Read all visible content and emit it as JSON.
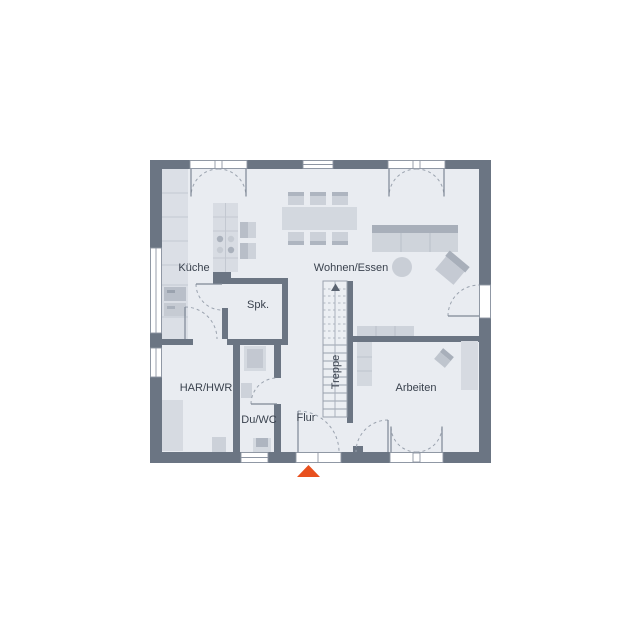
{
  "plan": {
    "type": "floor-plan",
    "rooms": {
      "kueche": {
        "label": "Küche"
      },
      "wohnen_essen": {
        "label": "Wohnen/Essen"
      },
      "spk": {
        "label": "Spk."
      },
      "treppe": {
        "label": "Treppe"
      },
      "har_hwr": {
        "label": "HAR/HWR"
      },
      "du_wc": {
        "label": "Du/WC"
      },
      "flur": {
        "label": "Flur"
      },
      "arbeiten": {
        "label": "Arbeiten"
      }
    },
    "markers": {
      "entrance_arrow": "entrance-triangle-south"
    },
    "colors": {
      "wall": "#6b7583",
      "floor": "#e9ecf1",
      "furniture_light": "#d7dbe2",
      "furniture_mid": "#c2c7d0",
      "furniture_dark": "#a9b0bb",
      "accent_entrance": "#e8501e",
      "label_text": "#3a424e"
    }
  }
}
